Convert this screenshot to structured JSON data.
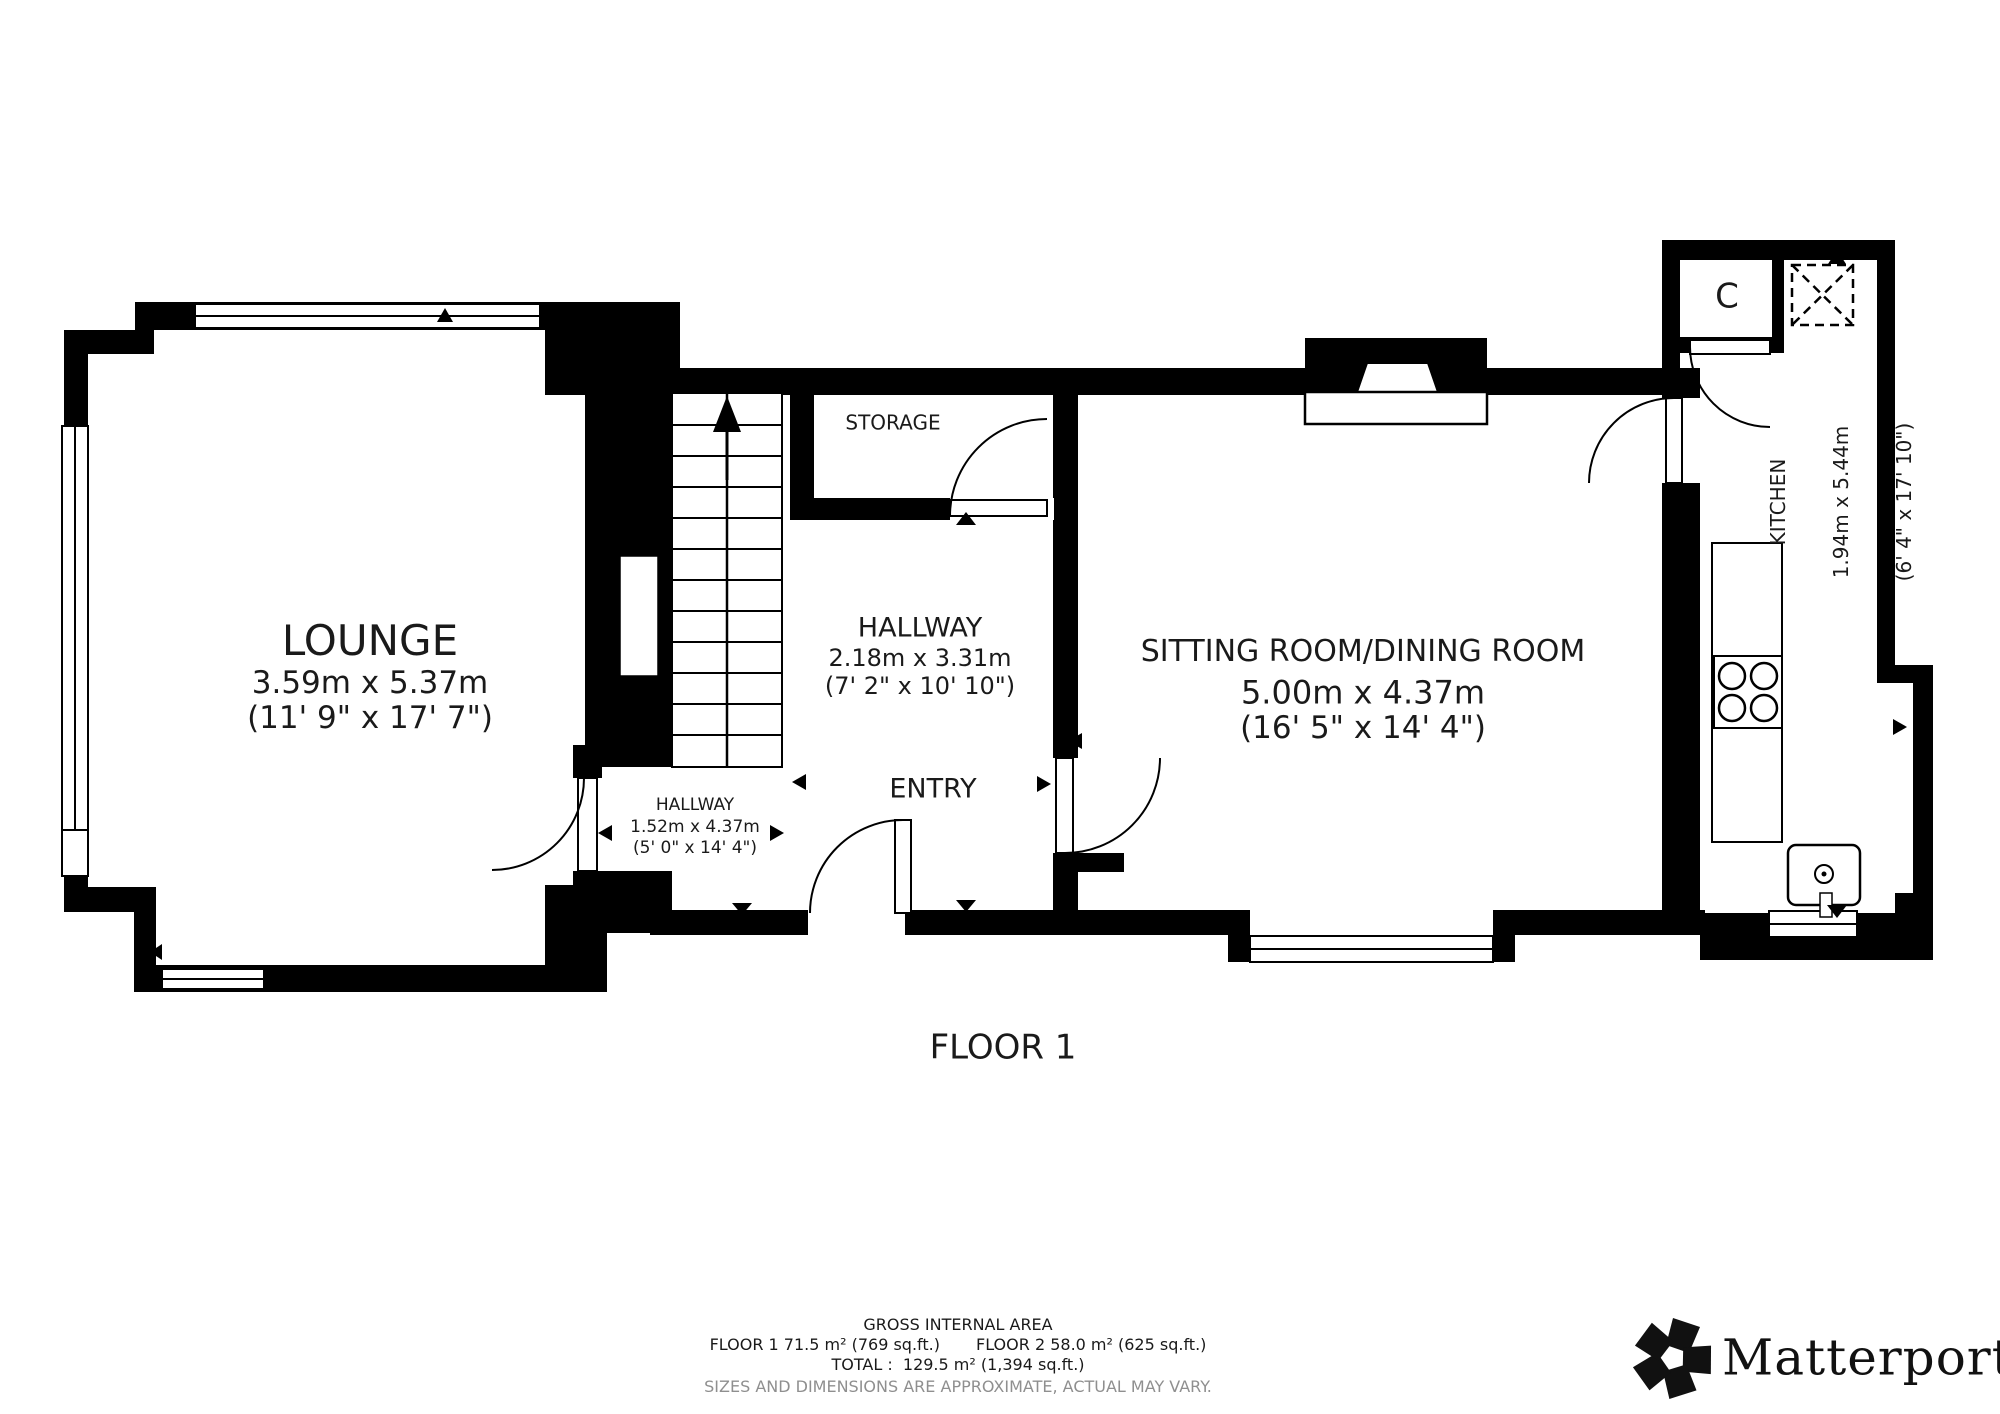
{
  "plan": {
    "floor_label": "FLOOR 1",
    "rooms": {
      "lounge": {
        "name": "LOUNGE",
        "metric": "3.59m x 5.37m",
        "imperial": "(11' 9\" x 17' 7\")"
      },
      "storage": {
        "name": "STORAGE"
      },
      "hallway_main": {
        "name": "HALLWAY",
        "metric": "2.18m x 3.31m",
        "imperial": "(7' 2\" x 10' 10\")"
      },
      "hallway_small": {
        "name": "HALLWAY",
        "metric": "1.52m x 4.37m",
        "imperial": "(5' 0\" x 14' 4\")"
      },
      "entry": {
        "name": "ENTRY"
      },
      "sitting": {
        "name": "SITTING ROOM/DINING ROOM",
        "metric": "5.00m x 4.37m",
        "imperial": "(16' 5\" x 14' 4\")"
      },
      "kitchen": {
        "name": "KITCHEN",
        "metric": "1.94m x 5.44m",
        "imperial": "(6' 4\" x 17' 10\")"
      },
      "closet": {
        "name": "C"
      }
    }
  },
  "footer": {
    "title": "GROSS INTERNAL AREA",
    "floor1_area": "FLOOR 1 71.5 m² (769 sq.ft.)",
    "floor2_area": "FLOOR 2 58.0 m² (625 sq.ft.)",
    "total": "TOTAL :  129.5 m² (1,394 sq.ft.)",
    "disclaimer": "SIZES AND DIMENSIONS ARE APPROXIMATE, ACTUAL MAY VARY.",
    "brand": "Matterport",
    "registered": "®"
  },
  "colors": {
    "wall": "#000000",
    "disclaimer": "#8f8f8f"
  }
}
